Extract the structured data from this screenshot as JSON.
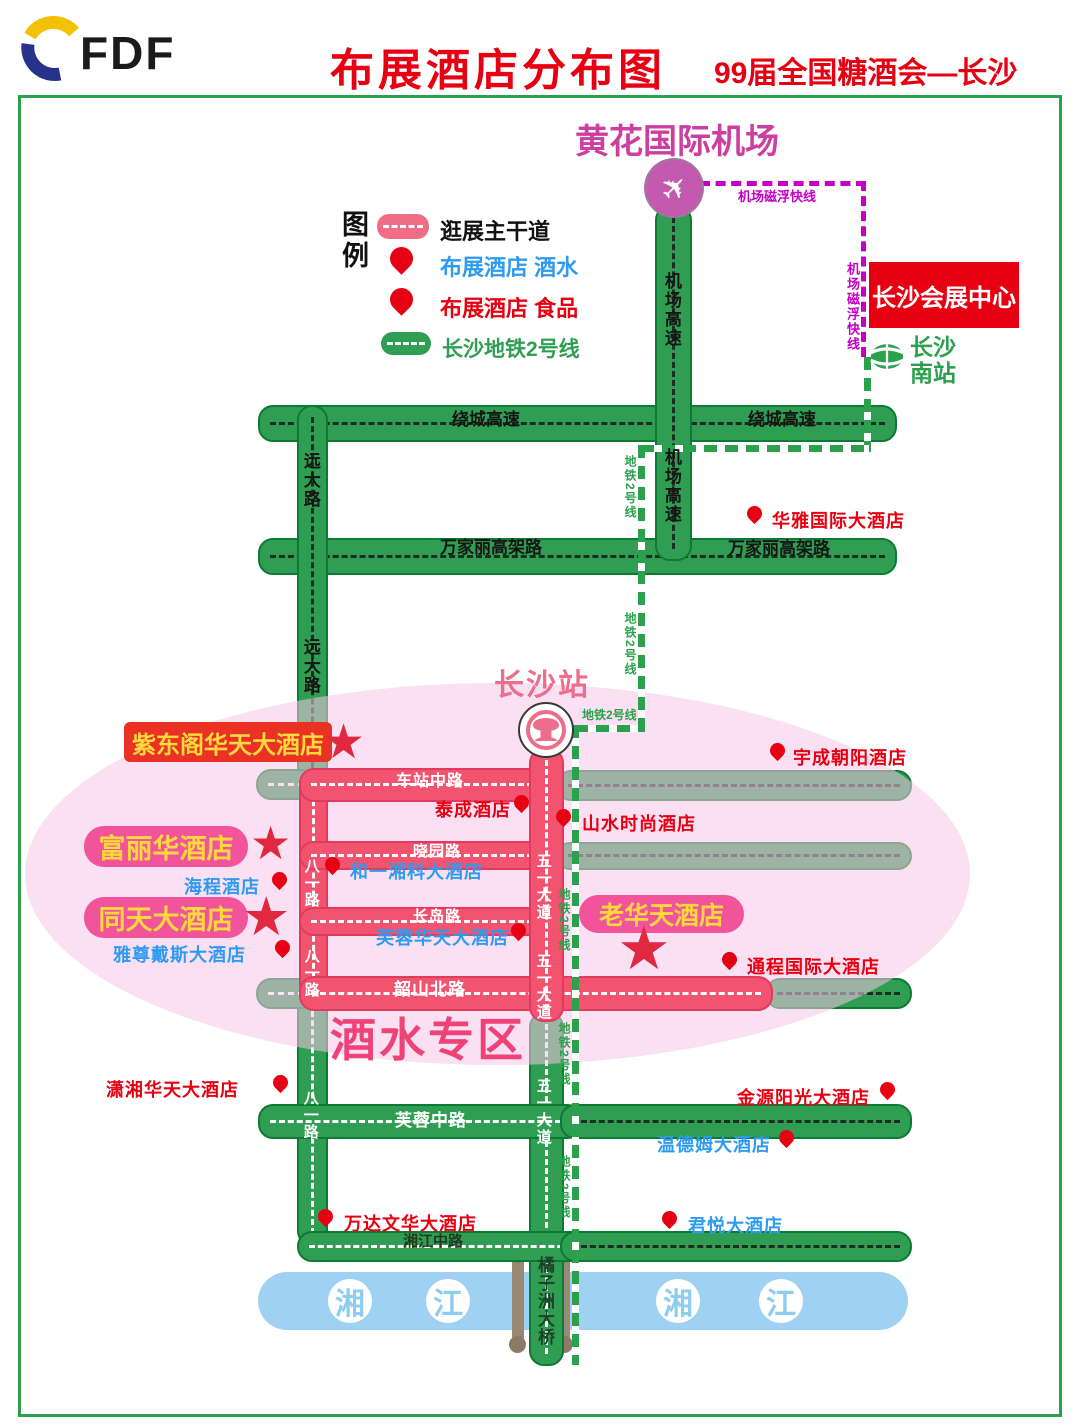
{
  "header": {
    "logo_text": "FDF",
    "title": "布展酒店分布图",
    "subtitle": "99届全国糖酒会—长沙"
  },
  "legend": {
    "title": "图例",
    "items": [
      {
        "label": "逛展主干道",
        "sample": "pink-road"
      },
      {
        "label": "布展酒店 酒水",
        "sample": "pin",
        "text_color": "blue"
      },
      {
        "label": "布展酒店 食品",
        "sample": "pin",
        "text_color": "red"
      },
      {
        "label": "长沙地铁2号线",
        "sample": "green-road",
        "text_color": "green"
      }
    ]
  },
  "landmarks": {
    "airport": "黄花国际机场",
    "convention_center": "长沙会展中心",
    "south_station_line1": "长沙",
    "south_station_line2": "南站",
    "changsha_station": "长沙站",
    "zone_label": "酒水专区",
    "bridge": "橘子洲大桥",
    "maglev_label": "机场磁浮快线",
    "metro_label": "地铁2号线"
  },
  "river": {
    "y": 1279,
    "chars": [
      {
        "t": "湘",
        "x": 328
      },
      {
        "t": "江",
        "x": 426
      },
      {
        "t": "湘",
        "x": 656
      },
      {
        "t": "江",
        "x": 759
      }
    ]
  },
  "road_labels": [
    {
      "text": "绕城高速",
      "x": 452,
      "y": 411,
      "fs": 17,
      "cls": "lbl-black"
    },
    {
      "text": "绕城高速",
      "x": 748,
      "y": 411,
      "fs": 17,
      "cls": "lbl-black"
    },
    {
      "text": "万家丽高架路",
      "x": 440,
      "y": 539,
      "fs": 17,
      "cls": "lbl-black"
    },
    {
      "text": "万家丽高架路",
      "x": 728,
      "y": 540,
      "fs": 17,
      "cls": "lbl-black"
    },
    {
      "text": "机场高速",
      "x": 662,
      "y": 272,
      "fs": 17,
      "cls": "lbl-black lbl-v"
    },
    {
      "text": "机场高速",
      "x": 662,
      "y": 448,
      "fs": 17,
      "cls": "lbl-black lbl-v"
    },
    {
      "text": "远大路",
      "x": 301,
      "y": 452,
      "fs": 17,
      "cls": "lbl-black lbl-v"
    },
    {
      "text": "远大路",
      "x": 301,
      "y": 638,
      "fs": 17,
      "cls": "lbl-black lbl-v"
    },
    {
      "text": "车站中路",
      "x": 396,
      "y": 774,
      "fs": 16,
      "cls": "lbl-white"
    },
    {
      "text": "晓园路",
      "x": 413,
      "y": 844,
      "fs": 15,
      "cls": "lbl-white"
    },
    {
      "text": "长岛路",
      "x": 413,
      "y": 909,
      "fs": 15,
      "cls": "lbl-white"
    },
    {
      "text": "韶山北路",
      "x": 394,
      "y": 981,
      "fs": 17,
      "cls": "lbl-white"
    },
    {
      "text": "芙蓉中路",
      "x": 395,
      "y": 1112,
      "fs": 17,
      "cls": "lbl-white"
    },
    {
      "text": "湘江中路",
      "x": 403,
      "y": 1234,
      "fs": 15,
      "cls": "lbl-dark"
    },
    {
      "text": "八一路",
      "x": 303,
      "y": 858,
      "fs": 15,
      "cls": "lbl-white lbl-v"
    },
    {
      "text": "八一路",
      "x": 303,
      "y": 948,
      "fs": 15,
      "cls": "lbl-white lbl-v"
    },
    {
      "text": "八一路",
      "x": 302,
      "y": 1090,
      "fs": 15,
      "cls": "lbl-white lbl-v"
    },
    {
      "text": "五一大道",
      "x": 535,
      "y": 853,
      "fs": 15,
      "cls": "lbl-white lbl-v"
    },
    {
      "text": "五一大道",
      "x": 535,
      "y": 953,
      "fs": 15,
      "cls": "lbl-white lbl-v"
    },
    {
      "text": "五一大道",
      "x": 535,
      "y": 1078,
      "fs": 15,
      "cls": "lbl-white lbl-v"
    }
  ],
  "metro_labels": [
    {
      "x": 752,
      "y": 429,
      "v": false
    },
    {
      "x": 624,
      "y": 455,
      "v": true
    },
    {
      "x": 624,
      "y": 612,
      "v": true
    },
    {
      "x": 582,
      "y": 709,
      "v": false
    },
    {
      "x": 558,
      "y": 888,
      "v": true
    },
    {
      "x": 558,
      "y": 1022,
      "v": true
    },
    {
      "x": 558,
      "y": 1155,
      "v": true
    }
  ],
  "maglev_labels": [
    {
      "x": 738,
      "y": 190,
      "v": false
    },
    {
      "x": 846,
      "y": 262,
      "v": true
    }
  ],
  "hotels": [
    {
      "name": "华雅国际大酒店",
      "category": "food",
      "tx": 772,
      "ty": 507,
      "px": 747,
      "py": 506
    },
    {
      "name": "宇成朝阳酒店",
      "category": "food",
      "tx": 793,
      "ty": 744,
      "px": 770,
      "py": 743
    },
    {
      "name": "泰成酒店",
      "category": "food",
      "tx": 435,
      "ty": 796,
      "px": 514,
      "py": 795
    },
    {
      "name": "山水时尚酒店",
      "category": "food",
      "tx": 582,
      "ty": 810,
      "px": 556,
      "py": 809
    },
    {
      "name": "和一湘科大酒店",
      "category": "wine",
      "tx": 350,
      "ty": 858,
      "px": 325,
      "py": 857
    },
    {
      "name": "海程酒店",
      "category": "wine",
      "tx": 184,
      "ty": 873,
      "px": 272,
      "py": 872
    },
    {
      "name": "雅尊戴斯大酒店",
      "category": "wine",
      "tx": 113,
      "ty": 941,
      "px": 275,
      "py": 940
    },
    {
      "name": "芙蓉华天大酒店",
      "category": "wine",
      "tx": 376,
      "ty": 924,
      "px": 511,
      "py": 923
    },
    {
      "name": "通程国际大酒店",
      "category": "food",
      "tx": 747,
      "ty": 953,
      "px": 722,
      "py": 952
    },
    {
      "name": "潇湘华天大酒店",
      "category": "food",
      "tx": 106,
      "ty": 1076,
      "px": 273,
      "py": 1075
    },
    {
      "name": "金源阳光大酒店",
      "category": "food",
      "tx": 737,
      "ty": 1084,
      "px": 880,
      "py": 1082
    },
    {
      "name": "温德姆大酒店",
      "category": "wine",
      "tx": 657,
      "ty": 1131,
      "px": 779,
      "py": 1130
    },
    {
      "name": "君悦大酒店",
      "category": "wine",
      "tx": 688,
      "ty": 1212,
      "px": 662,
      "py": 1211
    },
    {
      "name": "万达文华大酒店",
      "category": "food",
      "tx": 344,
      "ty": 1210,
      "px": 318,
      "py": 1209
    }
  ],
  "featured_hotels": [
    {
      "name": "紫东阁华天大酒店",
      "style": "red",
      "bx": 124,
      "by": 722,
      "bw": 208,
      "bh": 40,
      "fs": 24,
      "sx": 322,
      "sy": 719,
      "ss": 48
    },
    {
      "name": "富丽华酒店",
      "style": "pink",
      "bx": 84,
      "by": 826,
      "bw": 164,
      "bh": 41,
      "fs": 27,
      "sx": 250,
      "sy": 820,
      "ss": 46
    },
    {
      "name": "同天大酒店",
      "style": "pink",
      "bx": 84,
      "by": 897,
      "bw": 164,
      "bh": 41,
      "fs": 27,
      "sx": 242,
      "sy": 890,
      "ss": 54
    },
    {
      "name": "老华天酒店",
      "style": "pink",
      "bx": 579,
      "by": 895,
      "bw": 165,
      "bh": 38,
      "fs": 25,
      "sx": 617,
      "sy": 919,
      "ss": 60
    }
  ],
  "icons": {
    "star": "★",
    "plane": "✈"
  },
  "colors": {
    "title_red": "#e60012",
    "road_green": "#2f9e53",
    "road_green_border": "#0c7a32",
    "road_pink": "#f2536e",
    "road_pink_border": "#e03b5e",
    "metro_green": "#2ca14d",
    "maglev_magenta": "#c400c4",
    "river_blue": "#9fd1f2",
    "zone_pink_text": "#ef4276",
    "hotel_wine_blue": "#2e9bf0",
    "hotel_food_red": "#e60012",
    "featured_yellow": "#ffd83d",
    "featured_pink_bg": "#f2549b",
    "featured_red_bg": "#e93223",
    "star_red": "#e02840",
    "airport_magenta": "#cc3fa0",
    "station_pink": "#ec6e8c"
  }
}
